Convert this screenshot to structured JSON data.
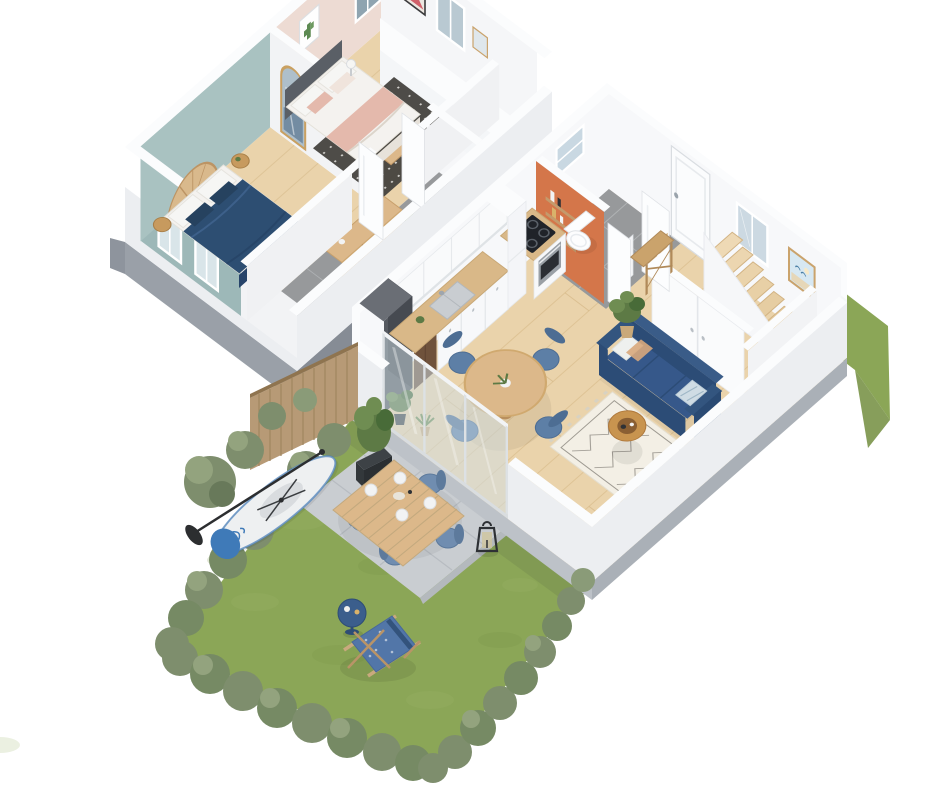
{
  "scene": {
    "title": "3D isometric floor plan — two-storey duplex apartment with private garden",
    "upper_floor_label": "Upper floor — two bedrooms and landing",
    "ground_floor_label": "Ground floor — open kitchen, living room, WC, entrance and stairs",
    "garden_label": "Garden with terrace, lawn and hedges",
    "background": "#ffffff"
  },
  "palette": {
    "grass": "#8ba657",
    "grassLight": "#9cb46a",
    "grassDark": "#7a9449",
    "hedge": "#7e8e6d",
    "hedgeLight": "#93a37e",
    "hedgeDark": "#68795a",
    "terrace": "#c9cdd1",
    "terraceJoint": "#b7bcc1",
    "path": "#b4b8b4",
    "fence": "#b79a76",
    "fenceLine": "#a0855f",
    "plinth": "#9aa0a8",
    "plinthDark": "#868c95",
    "slab": "#bdc2c8",
    "slabDark": "#aab0b7",
    "wallWhite": "#f7f8fa",
    "wallShade": "#eceef1",
    "wallTop": "#fbfcfd",
    "tealWall": "#a9c2c1",
    "tealWallSide": "#9db8b8",
    "pinkWall": "#eddbd3",
    "orangeWall": "#d4764a",
    "woodFloor": "#ead3ab",
    "woodFloorLine": "#d9bd8e",
    "tileFloor": "#97999b",
    "tileGrout": "#b4b7b9",
    "navy": "#2d4e72",
    "navyDark": "#26425f",
    "sofaNavy": "#36588a",
    "sofaNavyDark": "#2c4c76",
    "duvetWhite": "#f4f2ef",
    "pillowWhite": "#f6f6f4",
    "blushPink": "#e4b9ac",
    "rugDark": "#44423e",
    "rugCream": "#f3efe5",
    "rugLine": "#57544d",
    "woodLight": "#dcb88a",
    "woodMid": "#c79a5e",
    "woodDark": "#a87f48",
    "counterWood": "#d9b888",
    "cabinetWhite": "#f7f8fa",
    "brownCabinet": "#6f523c",
    "fridgeSteel": "#565a61",
    "fridgeSide": "#464a51",
    "hobBlack": "#202329",
    "ovenSteel": "#9aa0a6",
    "chairBlue": "#5d7fa6",
    "chairBlueDark": "#4d6d93",
    "outdoorChairBlue": "#708db0",
    "coffeeWood": "#c8944f",
    "glass": "#cfe0e8",
    "glassDark": "#8fa4b0",
    "mirrorGlass": "#aebfca",
    "artRed": "#cd5560",
    "artBeach": "#d7e8f2",
    "plantGreen": "#5d7a45",
    "plantGreenLight": "#6f8d52",
    "plantGreenDark": "#486b38",
    "potTan": "#c9a97a",
    "planterDark": "#3d4246",
    "paddleWhite": "#eef0f1",
    "paddleBlue": "#3f7ab8",
    "deckChairBlue": "#5276a8",
    "bistroBlue": "#3b5e8c",
    "lanternBlack": "#2e3135",
    "stairWood": "#e6cda2",
    "toiletWhite": "#fdfdfe",
    "washerWhite": "#f4f5f7"
  },
  "floors": [
    {
      "name": "Upper floor",
      "rooms": [
        {
          "name": "Bedroom 1",
          "accent": "teal wall",
          "furniture": [
            "double bed with navy duvet",
            "rattan arched headboard",
            "two round wooden stools",
            "arched gold mirror",
            "two windows"
          ]
        },
        {
          "name": "Bedroom 2",
          "accent": "blush pink wall",
          "furniture": [
            "double bed with grey headboard",
            "pink throw",
            "dark patterned rug",
            "wooden bench",
            "cactus artwork",
            "red abstract artwork",
            "two windows",
            "bedside lamp"
          ]
        },
        {
          "name": "Landing and bathroom",
          "accent": "grey tiles",
          "furniture": [
            "wooden sideboard",
            "potted plant",
            "stool",
            "stair opening"
          ]
        }
      ]
    },
    {
      "name": "Ground floor",
      "rooms": [
        {
          "name": "Kitchen",
          "accent": "white and wood",
          "furniture": [
            "fridge",
            "brown base unit",
            "worktop with sink",
            "induction hob",
            "oven",
            "tall cupboard",
            "upper cabinets"
          ]
        },
        {
          "name": "WC and laundry",
          "accent": "terracotta orange wall",
          "furniture": [
            "toilet",
            "washing machine",
            "wall shelves",
            "high window"
          ]
        },
        {
          "name": "Entrance hall",
          "accent": "white",
          "furniture": [
            "front door",
            "console table",
            "framed seaside print",
            "window"
          ]
        },
        {
          "name": "Living and dining room",
          "accent": "oak floor",
          "furniture": [
            "navy sofa with cushions",
            "berber rug",
            "round coffee table",
            "round dining table",
            "four blue chairs",
            "rattan armchair",
            "potted plants",
            "sliding glass bay"
          ]
        },
        {
          "name": "Staircase",
          "accent": "wood winder",
          "furniture": [
            "winder stairs",
            "under-stair cupboard",
            "balustrade"
          ]
        }
      ]
    }
  ],
  "garden": {
    "name": "Garden",
    "features": [
      "lawn",
      "clipped hedges",
      "trees",
      "wooden fence panel",
      "planter with shrub",
      "paved terrace",
      "outdoor dining table",
      "four outdoor chairs",
      "black lantern",
      "paddle board with paddle",
      "blue deck chair",
      "blue bistro table",
      "side path"
    ]
  }
}
